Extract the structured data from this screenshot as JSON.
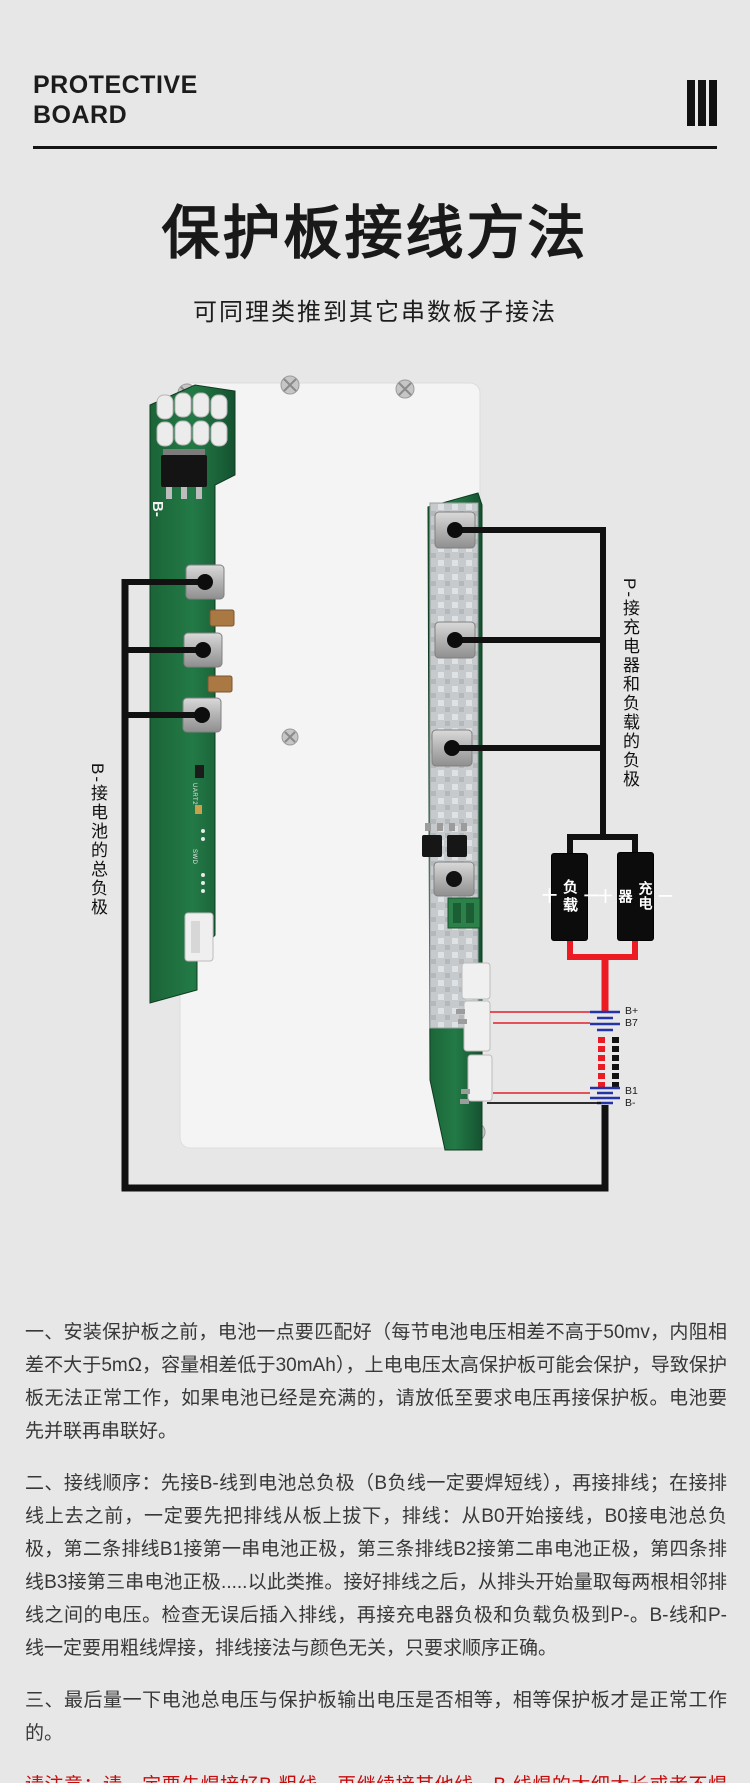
{
  "header": {
    "line1": "PROTECTIVE",
    "line2": "BOARD",
    "bars_icon": "three-vertical-bars"
  },
  "hero": {
    "title": "保护板接线方法",
    "subtitle": "可同理类推到其它串数板子接法"
  },
  "diagram": {
    "silkscreen": {
      "b_minus": "B-",
      "uart": "UART2",
      "swd": "SWD"
    },
    "left_note": "B-接电池的总负极",
    "right_note": "P-接充电器和负载的负极",
    "load_box": {
      "minus": "一",
      "label": "负载",
      "plus": "十"
    },
    "charger_box": {
      "minus": "一",
      "label": "充电器",
      "plus": "十"
    },
    "battery": {
      "b_plus": "B+",
      "b7": "B7",
      "b1": "B1",
      "b_minus": "B-"
    },
    "colors": {
      "wire_black": "#111111",
      "wire_red": "#ec1b23",
      "battery_blue": "#2433a8",
      "pcb_green": "#1e6f3e",
      "plate_white": "#f4f4f4",
      "warning_red": "#c50d0d",
      "background": "#e7e7e7"
    }
  },
  "instructions": {
    "para1": "一、安装保护板之前，电池一点要匹配好（每节电池电压相差不高于50mv，内阻相差不大于5mΩ，容量相差低于30mAh），上电电压太高保护板可能会保护，导致保护板无法正常工作，如果电池已经是充满的，请放低至要求电压再接保护板。电池要先并联再串联好。",
    "para2": "二、接线顺序：先接B-线到电池总负极（B负线一定要焊短线），再接排线；在接排线上去之前，一定要先把排线从板上拔下，排线：从B0开始接线，B0接电池总负极，第二条排线B1接第一串电池正极，第三条排线B2接第二串电池正极，第四条排线B3接第三串电池正极.....以此类推。接好排线之后，从排头开始量取每两根相邻排线之间的电压。检查无误后插入排线，再接充电器负极和负载负极到P-。B-线和P-线一定要用粗线焊接，排线接法与颜色无关，只要求顺序正确。",
    "para3": "三、最后量一下电池总电压与保护板输出电压是否相等，相等保护板才是正常工作的。",
    "warning_line1": "请注意：请一定要先焊接好B-粗线，再继续接其他线，B-线焊的太细太长或者不焊会烧板！",
    "warning_line2": "B-必须焊接粗短线！"
  }
}
